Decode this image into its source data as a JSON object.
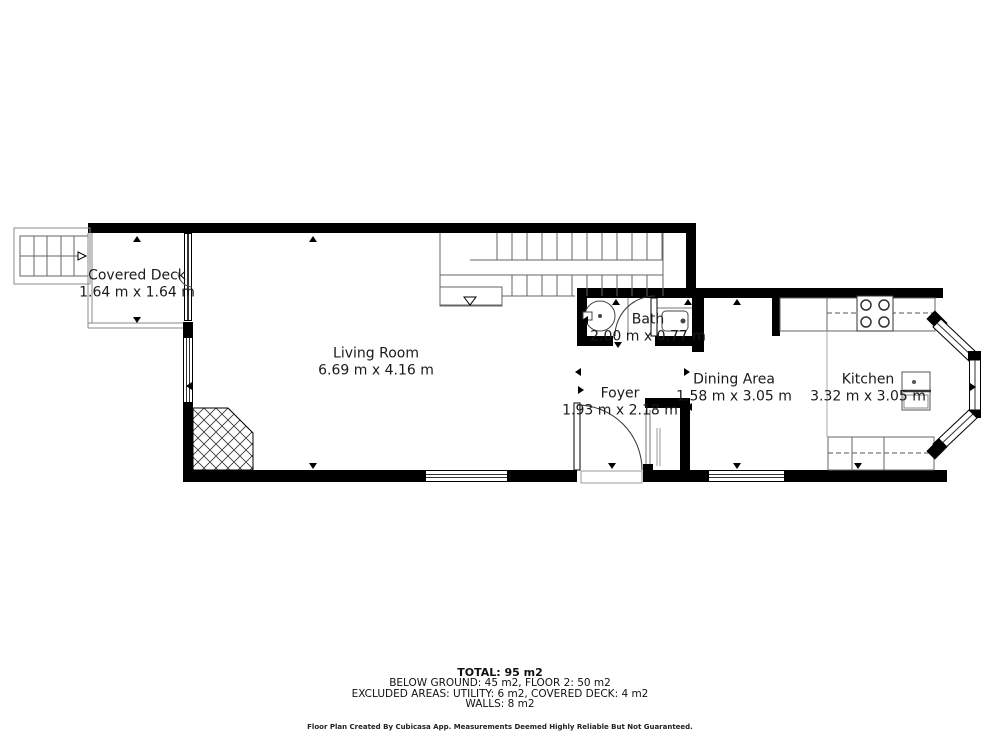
{
  "rooms": [
    {
      "name": "Covered Deck",
      "dims": "1.64 m x 1.64 m"
    },
    {
      "name": "Living Room",
      "dims": "6.69 m x 4.16 m"
    },
    {
      "name": "Bath",
      "dims": "2.00 m x 0.77 m"
    },
    {
      "name": "Foyer",
      "dims": "1.93 m x 2.18 m"
    },
    {
      "name": "Dining Area",
      "dims": "1.58 m x 3.05 m"
    },
    {
      "name": "Kitchen",
      "dims": "3.32 m x 3.05 m"
    }
  ],
  "summary": {
    "total": "TOTAL: 95 m2",
    "line1": "BELOW GROUND: 45 m2, FLOOR 2: 50 m2",
    "line2": "EXCLUDED AREAS: UTILITY: 6 m2, COVERED DECK: 4 m2",
    "line3": "WALLS: 8 m2"
  },
  "disclaimer": "Floor Plan Created By Cubicasa App. Measurements Deemed Highly Reliable But Not Guaranteed.",
  "colors": {
    "wall": "#000000",
    "line": "#555555",
    "text": "#1a1a1a",
    "background": "#ffffff"
  }
}
